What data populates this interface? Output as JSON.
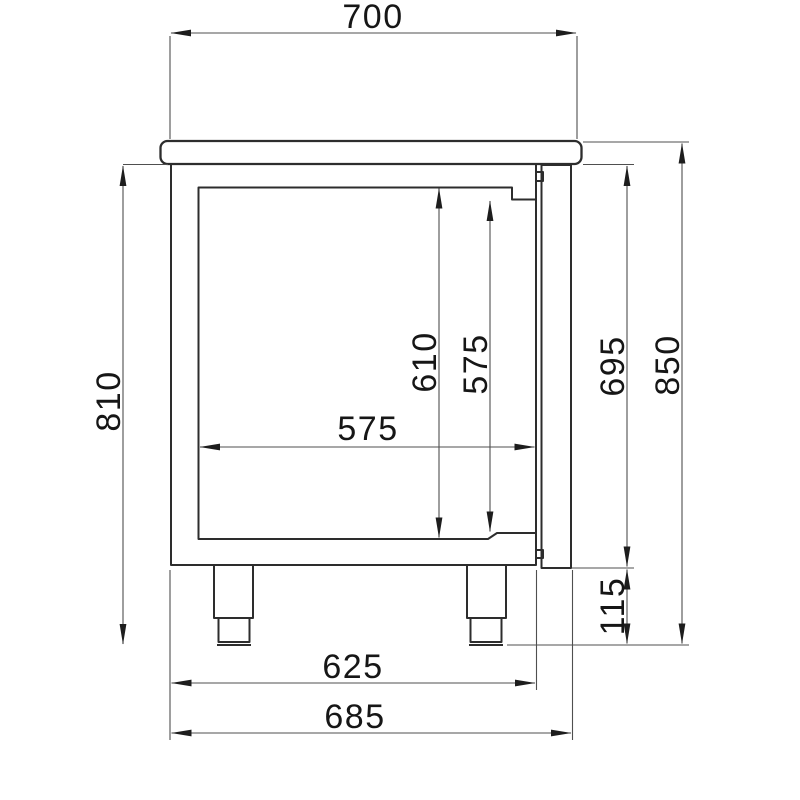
{
  "drawing": {
    "title": "refrigerated-counter-side-view-dimension-drawing",
    "background_color": "#ffffff",
    "line_color": "#2d2d2d",
    "dimension_line_color": "#4f4f4f",
    "text_color": "#161616",
    "dimensions": {
      "worktop_width": "700",
      "body_height": "810",
      "interior_height": "610",
      "door_opening_height": "575",
      "interior_depth": "575",
      "door_height": "695",
      "overall_height": "850",
      "foot_height": "115",
      "body_depth": "625",
      "overall_depth": "685"
    }
  }
}
